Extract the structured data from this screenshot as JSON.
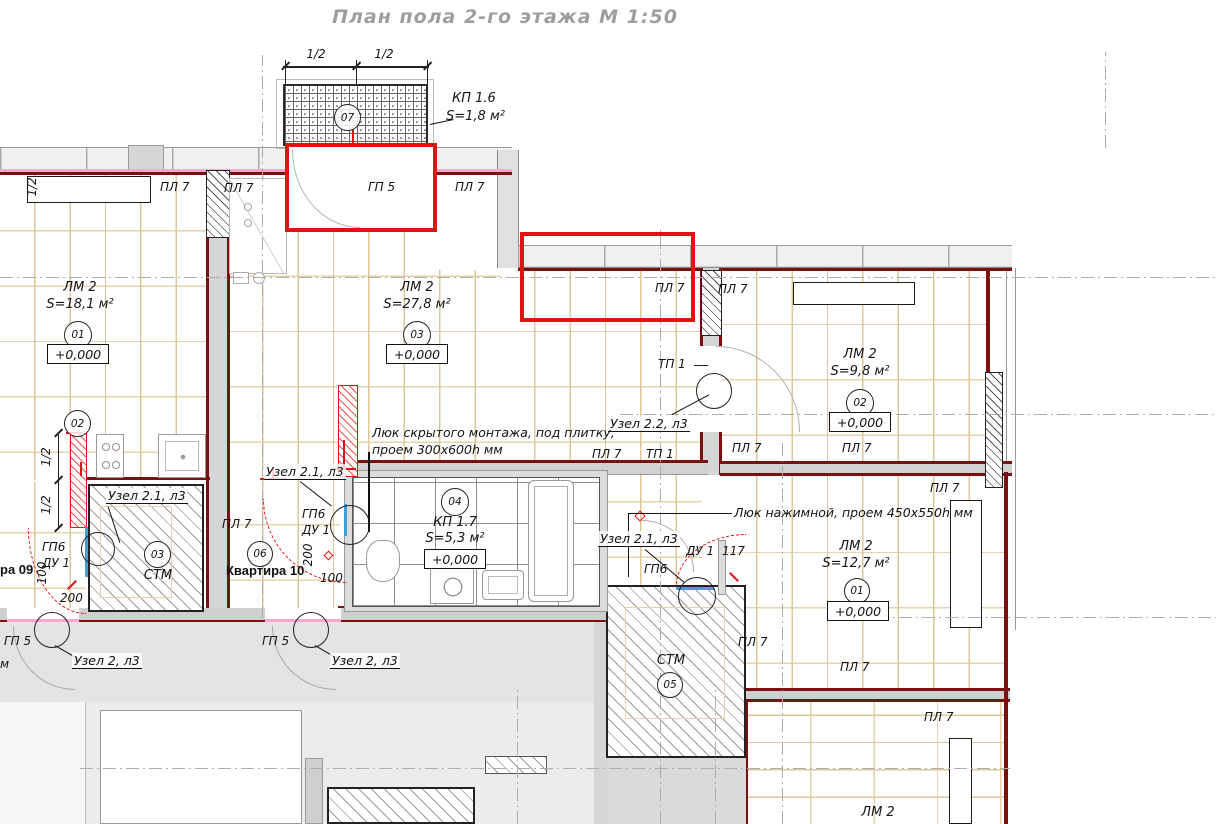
{
  "title": "План пола 2-го этажа М 1:50",
  "rooms": {
    "balcony": {
      "code": "07",
      "name": "КП 1.6",
      "area": "S=1,8 м²"
    },
    "living_left": {
      "code": "01",
      "name": "ЛМ 2",
      "area": "S=18,1 м²",
      "elev": "+0,000"
    },
    "living_mid": {
      "code": "03",
      "name": "ЛМ 2",
      "area": "S=27,8 м²",
      "elev": "+0,000"
    },
    "living_right": {
      "code": "02",
      "name": "ЛМ 2",
      "area": "S=9,8 м²",
      "elev": "+0,000"
    },
    "bathroom": {
      "code": "04",
      "name": "КП 1.7",
      "area": "S=5,3 м²",
      "elev": "+0,000"
    },
    "bedroom_right": {
      "code": "01",
      "name": "ЛМ 2",
      "area": "S=12,7 м²",
      "elev": "+0,000"
    },
    "stm_left": {
      "code": "03",
      "name": "СТМ"
    },
    "stm_mid": {
      "code": "05",
      "name": "СТМ"
    },
    "bottom_right": {
      "name": "ЛМ 2"
    },
    "kitchen_code": "06",
    "left_code": "02"
  },
  "marks": {
    "pl7": "ПЛ 7",
    "gp5": "ГП 5",
    "tp1": "ТП 1",
    "gp6": "ГП6",
    "du1": "ДУ 1"
  },
  "apartments": {
    "apt10": "Квартира 10",
    "apt09": "ра 09",
    "partial_m": "м"
  },
  "nodes": {
    "n21": "Узел 2.1, л3",
    "n22": "Узел 2.2, л3",
    "n2": "Узел 2, л3"
  },
  "notes": {
    "hidden_hatch_1": "Люк скрытого монтажа, под плитку,",
    "hidden_hatch_2": "проем 300х600h мм",
    "push_hatch": "Люк нажимной, проем 450х550h мм"
  },
  "dims": {
    "half": "1/2",
    "d100": "100",
    "d200": "200",
    "d117": "117"
  },
  "colors": {
    "highlight": "#e01212",
    "wall_line": "#7a1010",
    "plank_line": "#dfc79c",
    "pink": "#f7a6d0",
    "threshold_blue": "#41a0dc",
    "title_gray": "#9e9e9e"
  }
}
